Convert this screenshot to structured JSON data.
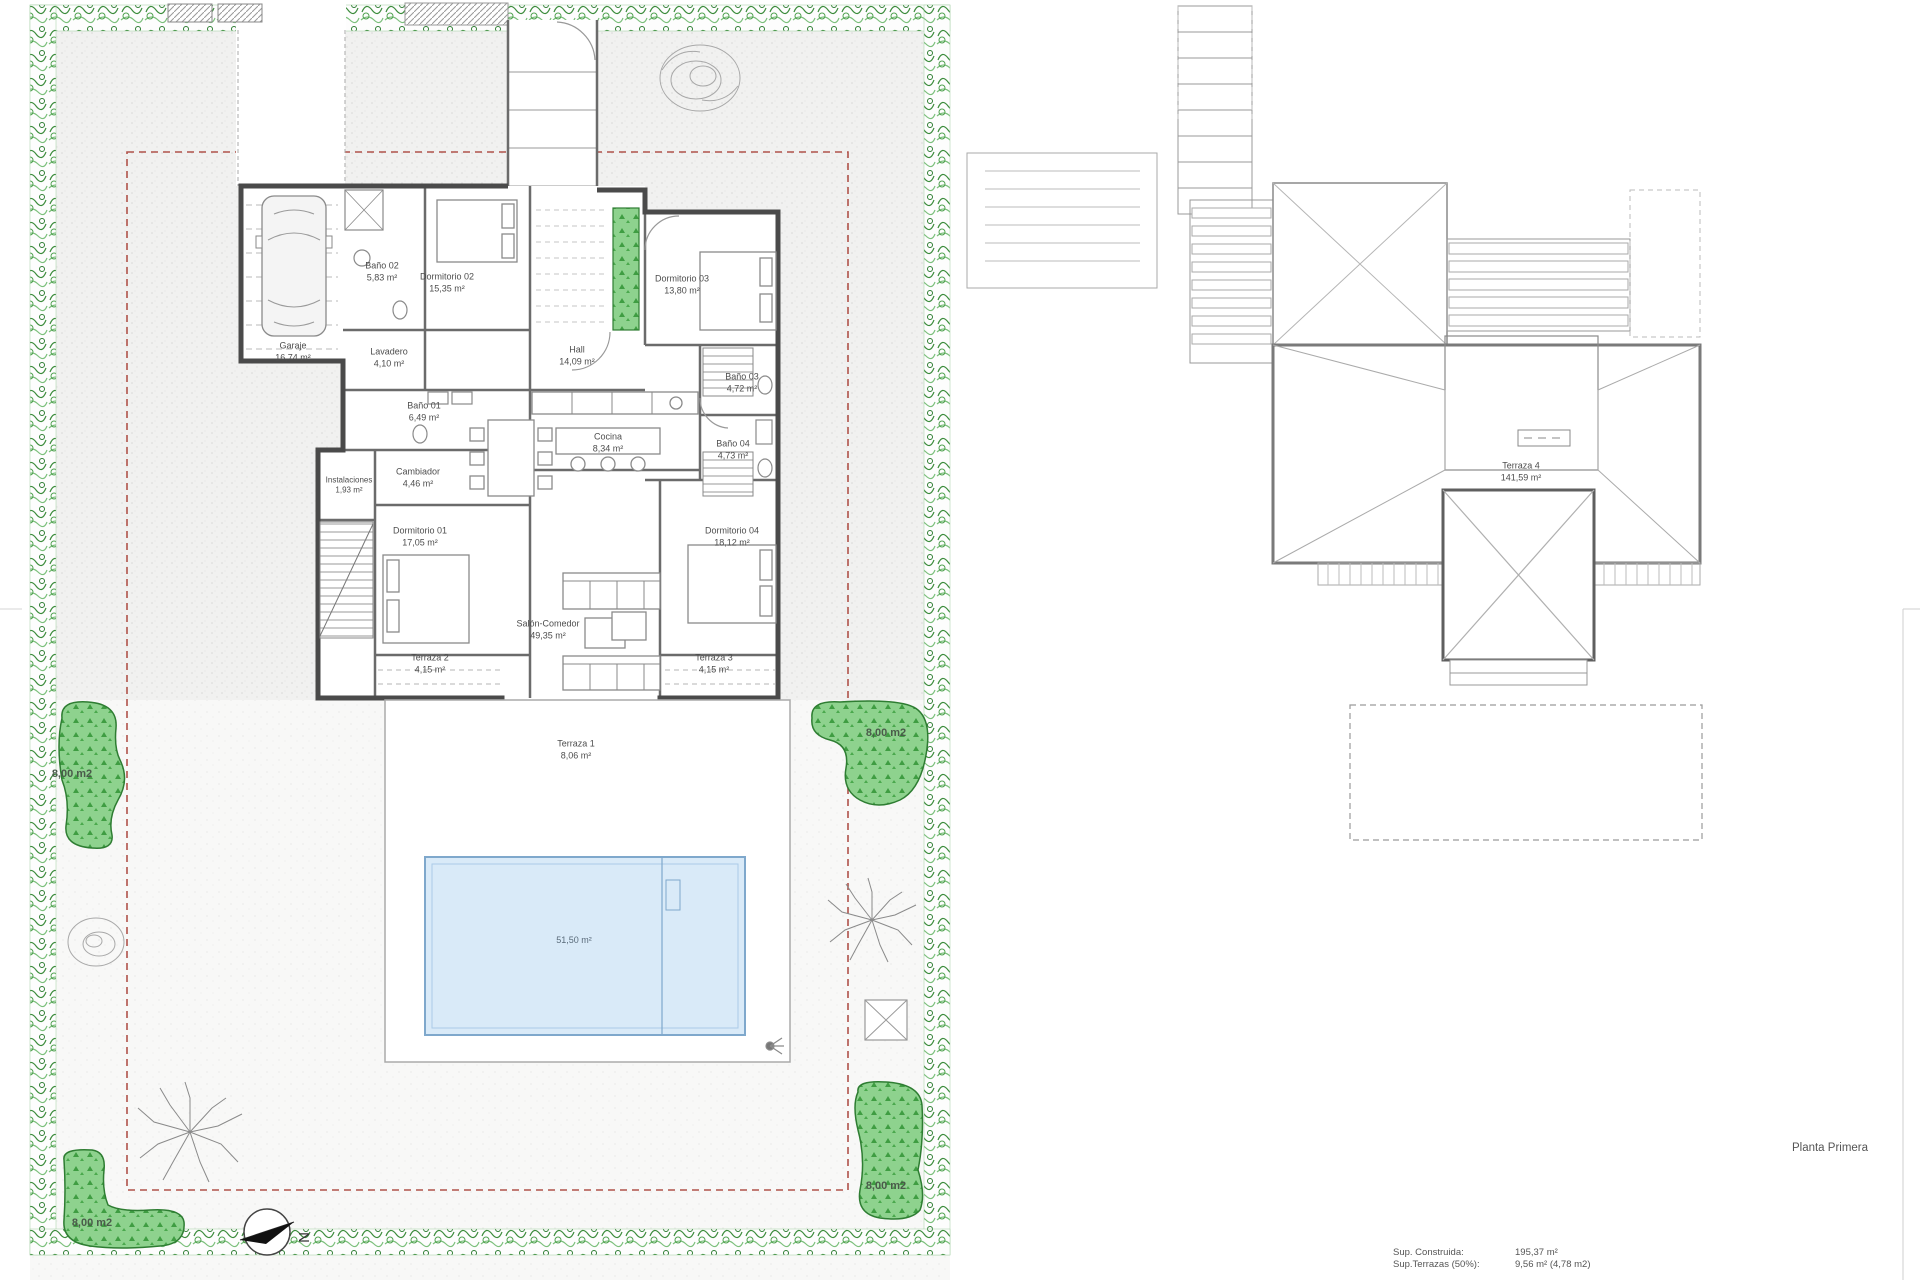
{
  "document": {
    "sheet_label": "Planta Primera"
  },
  "plan_ground": {
    "rooms": [
      {
        "name": "Garaje",
        "area": "16,74 m²"
      },
      {
        "name": "Baño 02",
        "area": "5,83 m²"
      },
      {
        "name": "Dormitorio 02",
        "area": "15,35 m²"
      },
      {
        "name": "Dormitorio 03",
        "area": "13,80 m²"
      },
      {
        "name": "Hall",
        "area": "14,09 m²"
      },
      {
        "name": "Lavadero",
        "area": "4,10 m²"
      },
      {
        "name": "Baño 01",
        "area": "6,49 m²"
      },
      {
        "name": "Baño 03",
        "area": "4,72 m²"
      },
      {
        "name": "Cocina",
        "area": "8,34 m²"
      },
      {
        "name": "Baño 04",
        "area": "4,73 m²"
      },
      {
        "name": "Cambiador",
        "area": "4,46 m²"
      },
      {
        "name": "Instalaciones",
        "area": "1,93 m²"
      },
      {
        "name": "Dormitorio 01",
        "area": "17,05 m²"
      },
      {
        "name": "Dormitorio 04",
        "area": "18,12 m²"
      },
      {
        "name": "Salón-Comedor",
        "area": "49,35 m²"
      },
      {
        "name": "Terraza 2",
        "area": "4,15 m²"
      },
      {
        "name": "Terraza 3",
        "area": "4,15 m²"
      },
      {
        "name": "Terraza 1",
        "area": "8,06 m²"
      }
    ],
    "pool": {
      "area": "51,50 m²"
    },
    "lawn_labels": [
      {
        "text": "8,00 m2"
      },
      {
        "text": "8,00 m2"
      },
      {
        "text": "8,00 m2"
      },
      {
        "text": "8,00 m2"
      }
    ],
    "compass": {
      "letter": "N"
    }
  },
  "plan_first": {
    "label": "Planta Primera",
    "room": {
      "name": "Terraza 4",
      "area": "141,59 m²"
    }
  },
  "summary": {
    "rows": [
      {
        "label": "Sup. Construida:",
        "value": "195,37 m²"
      },
      {
        "label": "Sup.Terrazas (50%):",
        "value": "9,56 m² (4,78 m2)"
      }
    ]
  },
  "colors": {
    "hedge_green": "#3c8c3c",
    "lawn_green": "#8ed28e",
    "pool_blue": "#d9eaf8",
    "setback_red": "#b0524a",
    "wall_gray": "#4a4a4a"
  }
}
